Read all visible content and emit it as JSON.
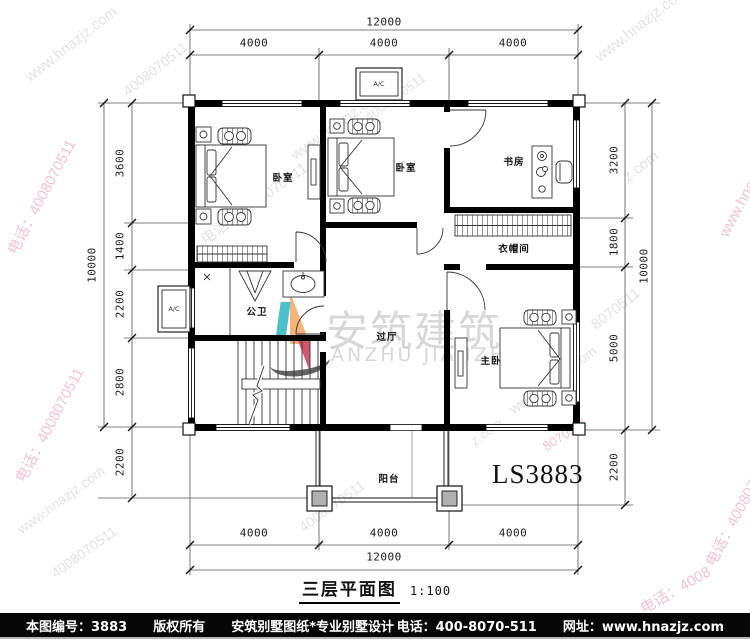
{
  "drawing": {
    "plan_code": "LS3883",
    "title": "三层平面图",
    "scale": "1:100",
    "ac_label": "A/C"
  },
  "rooms": {
    "bedroom1": "卧室",
    "bedroom2": "卧室",
    "study": "书房",
    "cloakroom": "衣帽间",
    "bathroom": "公卫",
    "hall": "过厅",
    "master": "主卧",
    "balcony": "阳台"
  },
  "dims": {
    "top_total": "12000",
    "top_segs": [
      "4000",
      "4000",
      "4000"
    ],
    "bottom_total": "12000",
    "bottom_segs": [
      "4000",
      "4000",
      "4000"
    ],
    "left_total": "10000",
    "left_segs": [
      "3600",
      "1400",
      "2200",
      "2800"
    ],
    "left_below": "2200",
    "right_total": "10000",
    "right_segs": [
      "3200",
      "1800",
      "5000"
    ],
    "right_below": "2200"
  },
  "brand": {
    "cn": "安筑建筑",
    "en": "ANZHU JIANZHU"
  },
  "watermarks": {
    "site": "www.hnazjz.com",
    "phone": "电话：4008070511",
    "digits": "4008070511",
    "site_frag": "z.com",
    "digits_frag": "8070511",
    "phone_frag": "电话：4008"
  },
  "footer": {
    "sheet_no": "本图编号：3883",
    "copyright": "版权所有",
    "brand_line": "安筑别墅图纸*专业别墅设计",
    "phone": "电话：400-8070-511",
    "site": "网址：www.hnazjz.com"
  }
}
